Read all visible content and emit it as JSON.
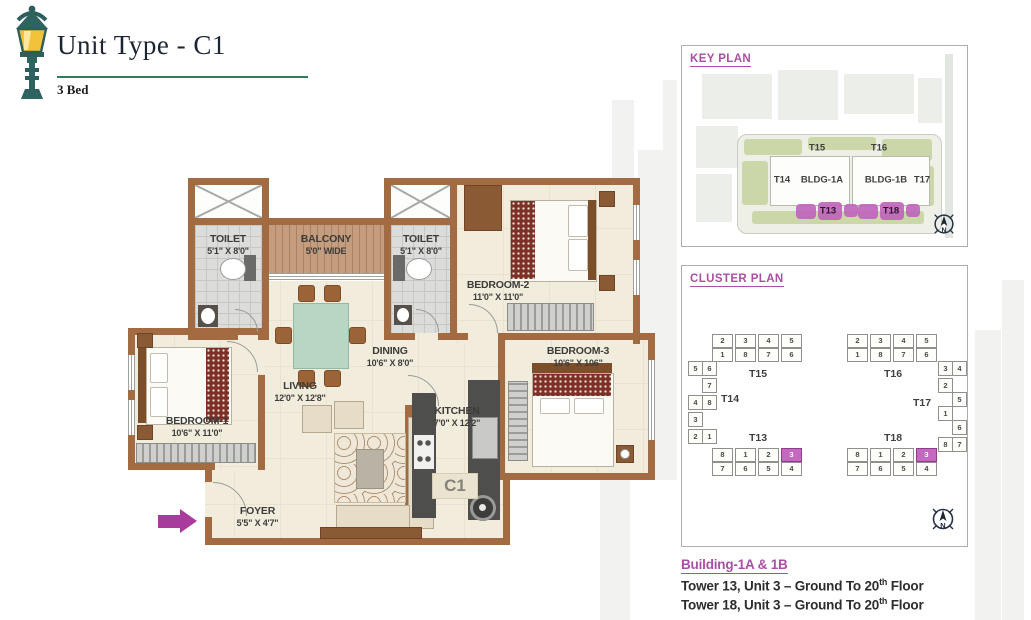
{
  "header": {
    "title": "Unit Type - C1",
    "subtitle": "3 Bed"
  },
  "floor_plan": {
    "unit_label": "C1",
    "rooms": {
      "toilet1": {
        "name": "TOILET",
        "dims": "5'1\" X 8'0\""
      },
      "balcony": {
        "name": "BALCONY",
        "dims": "5'0\" WIDE"
      },
      "toilet2": {
        "name": "TOILET",
        "dims": "5'1\" X 8'0\""
      },
      "bedroom2": {
        "name": "BEDROOM-2",
        "dims": "11'0\" X 11'0\""
      },
      "bedroom3": {
        "name": "BEDROOM-3",
        "dims": "10'6\" X 106\""
      },
      "dining": {
        "name": "DINING",
        "dims": "10'6\" X 8'0\""
      },
      "living": {
        "name": "LIVING",
        "dims": "12'0\" X 12'8\""
      },
      "kitchen": {
        "name": "KITCHEN",
        "dims": "7'0\" X 12'2\""
      },
      "bedroom1": {
        "name": "BEDROOM-1",
        "dims": "10'6\" X 11'0\""
      },
      "foyer": {
        "name": "FOYER",
        "dims": "5'5\" X 4'7\""
      }
    }
  },
  "key_plan": {
    "title": "KEY PLAN",
    "labels": {
      "t14": "T14",
      "t15": "T15",
      "t16": "T16",
      "t17": "T17",
      "bldg1a": "BLDG-1A",
      "bldg1b": "BLDG-1B",
      "t13": "T13",
      "t18": "T18"
    },
    "compass_n": "N"
  },
  "cluster_plan": {
    "title": "CLUSTER PLAN",
    "highlight_unit": "3",
    "left": {
      "top_label": "T15",
      "side_label": "T14",
      "bottom_label": "T13",
      "top_units_row1": [
        "2",
        "3",
        "4",
        "5"
      ],
      "top_units_row2": [
        "1",
        "8",
        "7",
        "6"
      ],
      "side_units": [
        "5",
        "6",
        "7",
        "4",
        "8",
        "3",
        "2",
        "1"
      ],
      "bottom_units_row1": [
        "8",
        "1",
        "2",
        "3"
      ],
      "bottom_units_row2": [
        "7",
        "6",
        "5",
        "4"
      ]
    },
    "right": {
      "top_label": "T16",
      "side_label": "T17",
      "bottom_label": "T18",
      "top_units_row1": [
        "2",
        "3",
        "4",
        "5"
      ],
      "top_units_row2": [
        "1",
        "8",
        "7",
        "6"
      ],
      "side_units": [
        "3",
        "4",
        "2",
        "5",
        "1",
        "6",
        "8",
        "7"
      ],
      "bottom_units_row1": [
        "8",
        "1",
        "2",
        "3"
      ],
      "bottom_units_row2": [
        "7",
        "6",
        "5",
        "4"
      ]
    },
    "compass_n": "N"
  },
  "footer": {
    "building": "Building-1A & 1B",
    "lines": [
      {
        "text": "Tower 13, Unit 3 – Ground To 20",
        "sup": "th",
        "tail": " Floor"
      },
      {
        "text": "Tower 18, Unit 3 – Ground To 20",
        "sup": "th",
        "tail": " Floor"
      }
    ]
  },
  "colors": {
    "accent_purple": "#a94fa4",
    "accent_green": "#2f7d5b",
    "wall_brown": "#a26b42",
    "highlight_magenta": "#c469bf",
    "entry_arrow": "#a93b9c"
  }
}
